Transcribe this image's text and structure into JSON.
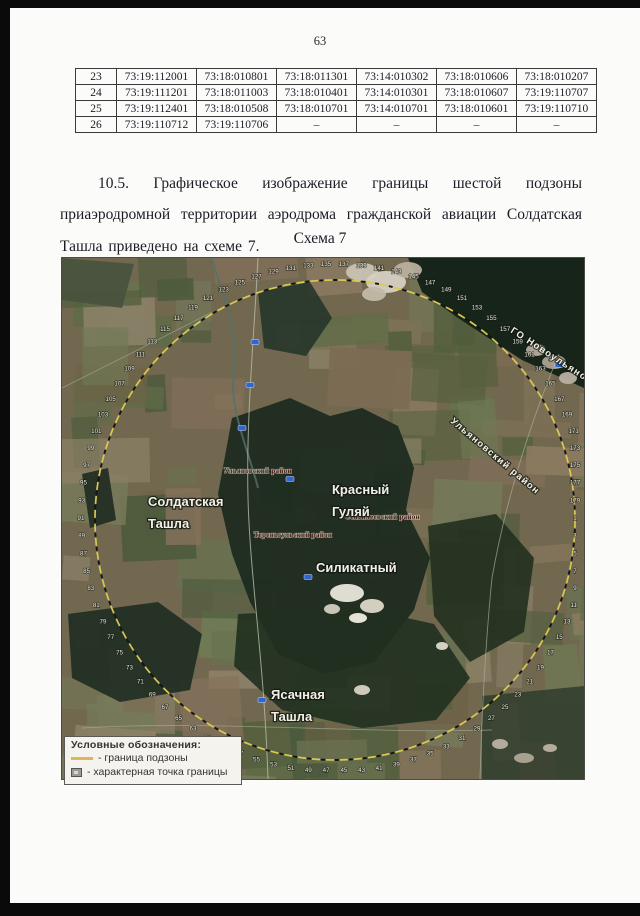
{
  "page": {
    "number": "63"
  },
  "table": {
    "rows": [
      [
        "23",
        "73:19:112001",
        "73:18:010801",
        "73:18:011301",
        "73:14:010302",
        "73:18:010606",
        "73:18:010207"
      ],
      [
        "24",
        "73:19:111201",
        "73:18:011003",
        "73:18:010401",
        "73:14:010301",
        "73:18:010607",
        "73:19:110707"
      ],
      [
        "25",
        "73:19:112401",
        "73:18:010508",
        "73:18:010701",
        "73:14:010701",
        "73:18:010601",
        "73:19:110710"
      ],
      [
        "26",
        "73:19:110712",
        "73:19:110706",
        "–",
        "–",
        "–",
        "–"
      ]
    ]
  },
  "paragraph": {
    "text": "10.5. Графическое изображение границы шестой подзоны приаэродромной территории аэродрома гражданской авиации Солдатская Ташла приведено на схеме 7."
  },
  "figure": {
    "caption": "Схема 7"
  },
  "map": {
    "place_labels": [
      {
        "name": "label-soldatskaya-tashla",
        "lines": [
          "Солдатская",
          "Ташла"
        ],
        "x": 86,
        "y": 248
      },
      {
        "name": "label-krasny-gulyay",
        "lines": [
          "Красный",
          "Гуляй"
        ],
        "x": 270,
        "y": 236
      },
      {
        "name": "label-silikatny",
        "lines": [
          "Силикатный"
        ],
        "x": 254,
        "y": 314
      },
      {
        "name": "label-yasachnaya-tashla",
        "lines": [
          "Ясачная",
          "Ташла"
        ],
        "x": 209,
        "y": 441
      }
    ],
    "district_labels": [
      {
        "name": "label-go-novoulyanovsk",
        "text": "ГО Новоульяновск",
        "x": 448,
        "y": 74,
        "rotate": 33,
        "style": "big"
      },
      {
        "name": "label-ulyanovsky-rayon-diagonal",
        "text": "Ульяновский район",
        "x": 388,
        "y": 164,
        "rotate": 40,
        "style": "big"
      },
      {
        "name": "label-ulyanovsky-rayon",
        "text": "Ульяновский район",
        "x": 162,
        "y": 215,
        "rotate": 0,
        "style": "small"
      },
      {
        "name": "label-terengulsky-rayon",
        "text": "Тереньгульский район",
        "x": 192,
        "y": 279,
        "rotate": 0,
        "style": "small"
      },
      {
        "name": "label-sengileevsky-rayon",
        "text": "Сенгилеевский район",
        "x": 283,
        "y": 261,
        "rotate": 0,
        "style": "small"
      }
    ],
    "boundary": {
      "numbers": [
        1,
        3,
        5,
        7,
        9,
        11,
        13,
        15,
        17,
        19,
        21,
        23,
        25,
        27,
        29,
        31,
        33,
        35,
        37,
        39,
        41,
        43,
        45,
        47,
        49,
        51,
        53,
        55,
        57,
        59,
        61,
        63,
        65,
        67,
        69,
        71,
        73,
        75,
        77,
        79,
        81,
        83,
        85,
        87,
        89,
        91,
        93,
        95,
        97,
        99,
        101,
        103,
        105,
        107,
        109,
        111,
        113,
        115,
        117,
        119,
        121,
        123,
        125,
        127,
        129,
        131,
        133,
        135,
        137,
        139,
        141,
        143,
        145,
        147,
        149,
        151,
        153,
        155,
        157,
        159,
        161,
        163,
        165,
        167,
        169,
        171,
        173,
        175,
        177,
        179
      ],
      "center_x": 273,
      "center_y": 262,
      "radius": 240,
      "label_radius": 254,
      "line_color": "#d9c94e",
      "alt_dash_color": "#141414"
    },
    "road_markers": [
      {
        "x": 193,
        "y": 84
      },
      {
        "x": 188,
        "y": 127
      },
      {
        "x": 180,
        "y": 170
      },
      {
        "x": 228,
        "y": 221
      },
      {
        "x": 246,
        "y": 319
      },
      {
        "x": 200,
        "y": 442
      },
      {
        "x": 497,
        "y": 107
      }
    ],
    "legend": {
      "title": "Условные обозначения:",
      "items": [
        {
          "icon": "boundary-line-icon",
          "label": "- граница подзоны"
        },
        {
          "icon": "boundary-point-icon",
          "label": "- характерная точка границы"
        }
      ]
    }
  },
  "colors": {
    "boundary_yellow": "#d9c94e",
    "marker_blue": "#2f66d4",
    "map_label_white": "#f2efe6"
  }
}
